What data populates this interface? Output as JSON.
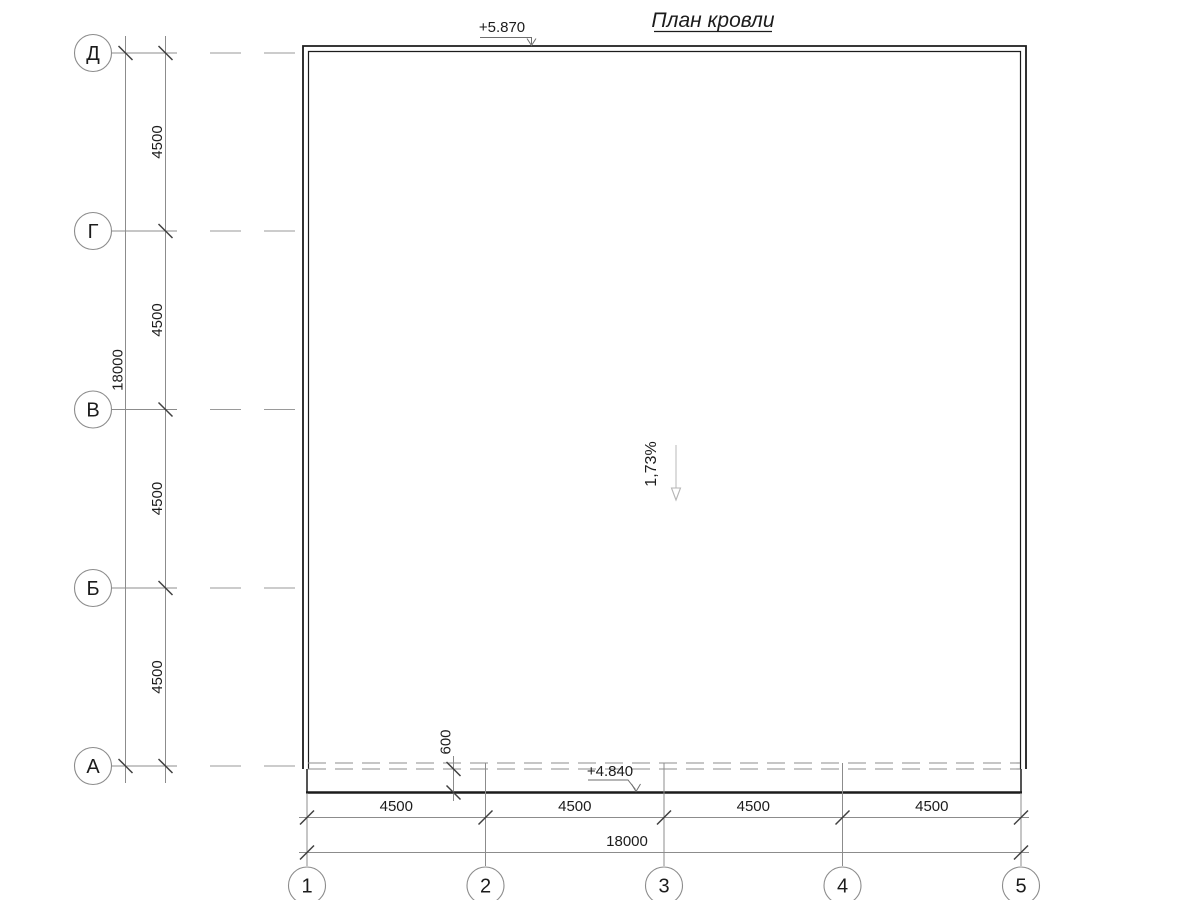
{
  "title": "План кровли",
  "colors": {
    "line_dark": "#1c1c1c",
    "line_thin": "#8c8c8c",
    "tick": "#404040",
    "text": "#1c1c1c",
    "slope_arrow": "#c4c4c4",
    "background": "#ffffff"
  },
  "row_axes": [
    {
      "label": "Д"
    },
    {
      "label": "Г"
    },
    {
      "label": "В"
    },
    {
      "label": "Б"
    },
    {
      "label": "А"
    }
  ],
  "col_axes": [
    {
      "label": "1"
    },
    {
      "label": "2"
    },
    {
      "label": "3"
    },
    {
      "label": "4"
    },
    {
      "label": "5"
    }
  ],
  "dimensions": {
    "left_segments": [
      "4500",
      "4500",
      "4500",
      "4500"
    ],
    "left_total": "18000",
    "bottom_segments": [
      "4500",
      "4500",
      "4500",
      "4500"
    ],
    "bottom_total": "18000",
    "eave_overhang": "600"
  },
  "elevations": {
    "top": "+5.870",
    "bottom": "+4.840"
  },
  "slope": {
    "value": "1,73%"
  }
}
